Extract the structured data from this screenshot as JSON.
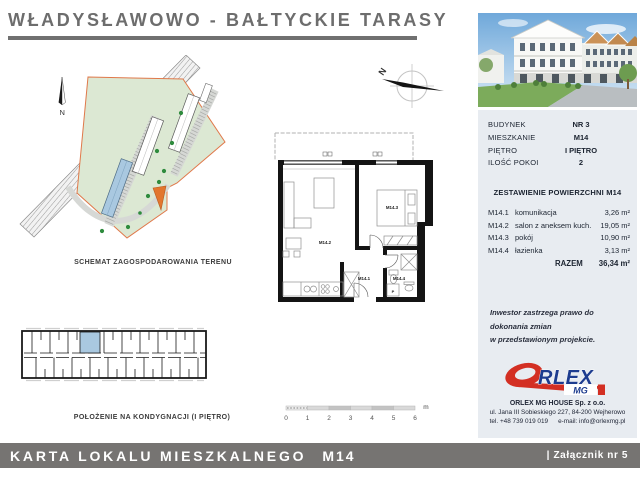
{
  "header": {
    "title": "WŁADYSŁAWOWO - BAŁTYCKIE TARASY"
  },
  "site_plan": {
    "caption": "SCHEMAT ZAGOSPODAROWANIA TERENU",
    "north_label": "N"
  },
  "compass": {
    "north_label": "N"
  },
  "floor_plan": {
    "labels": {
      "hall": "M14.1",
      "living": "M14.2",
      "room": "M14.3",
      "bath": "M14.4"
    },
    "washer_label": "P"
  },
  "key_plan": {
    "caption": "POŁOŻENIE NA KONDYGNACJI (I PIĘTRO)"
  },
  "scale_bar": {
    "ticks": [
      "0",
      "1",
      "2",
      "3",
      "4",
      "5",
      "6"
    ],
    "unit_label": "m"
  },
  "info_panel": {
    "details": [
      {
        "label": "BUDYNEK",
        "value": "NR 3"
      },
      {
        "label": "MIESZKANIE",
        "value": "M14"
      },
      {
        "label": "PIĘTRO",
        "value": "I PIĘTRO"
      },
      {
        "label": "ILOŚĆ POKOI",
        "value": "2"
      }
    ],
    "area_table": {
      "title": "ZESTAWIENIE POWIERZCHNI M14",
      "rows": [
        {
          "code": "M14.1",
          "name": "komunikacja",
          "area": "3,26 m²"
        },
        {
          "code": "M14.2",
          "name": "salon z aneksem kuch.",
          "area": "19,05 m²"
        },
        {
          "code": "M14.3",
          "name": "pokój",
          "area": "10,90 m²"
        },
        {
          "code": "M14.4",
          "name": "łazienka",
          "area": "3,13 m²"
        }
      ],
      "total_label": "RAZEM",
      "total_value": "36,34 m²"
    },
    "disclaimer": {
      "line1": "Inwestor zastrzega prawo do dokonania zmian",
      "line2": "w przedstawionym projekcie."
    },
    "company": {
      "logo_main": "RLEX",
      "logo_sub": "MG",
      "name": "ORLEX MG HOUSE  Sp. z o.o.",
      "address": "ul. Jana III Sobieskiego 227, 84-200 Wejherowo",
      "phone": "tel.  +48 739 019 019",
      "email": "e-mail: info@orlexmg.pl"
    }
  },
  "footer": {
    "title": "KARTA LOKALU MIESZKALNEGO",
    "unit": "M14",
    "attachment": "| Załącznik nr 5"
  },
  "colors": {
    "accent_red": "#d32f23",
    "logo_navy": "#1d3c8f",
    "panel_bg": "#e8ecf1",
    "footer_gray": "#767472",
    "highlight_blue": "#a9c8e0",
    "site_green": "#dce8d3",
    "playground_orange": "#e2762e"
  }
}
